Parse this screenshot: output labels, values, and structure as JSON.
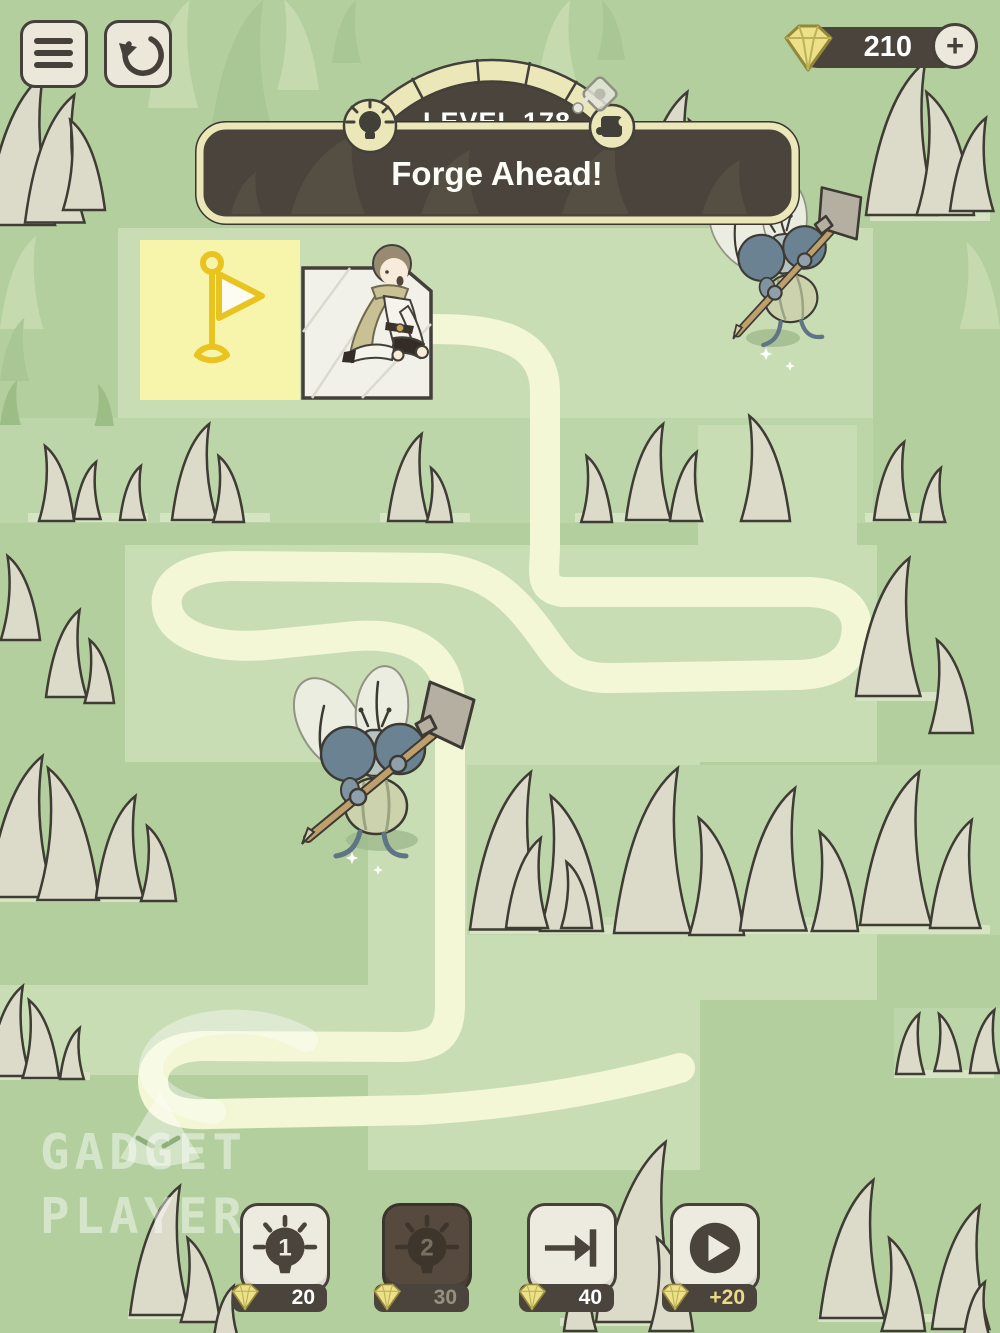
{
  "hud": {
    "menu_icon": "hamburger-icon",
    "restart_icon": "restart-icon",
    "gems": {
      "count": "210",
      "add_label": "+",
      "gem_icon": "gem-icon"
    }
  },
  "level": {
    "label": "LEVEL 178",
    "title": "Forge Ahead!",
    "hint_badge_icon": "lightbulb-icon",
    "puzzle_badge_icon": "puzzle-piece-icon"
  },
  "board": {
    "goal_icon": "flag-icon",
    "player": "kneeling-boy-character",
    "enemies": [
      "fly-with-swatter",
      "fly-with-swatter"
    ],
    "drawn_path": "hand-drawn-cream-line"
  },
  "toolbar": {
    "hint1": {
      "number": "1",
      "cost": "20"
    },
    "hint2": {
      "number": "2",
      "cost": "30"
    },
    "skip": {
      "cost": "40"
    },
    "reward": {
      "cost": "+20"
    }
  },
  "watermark": {
    "line1": "GADGET",
    "line2": "PLAYER"
  },
  "colors": {
    "base_green": "#b3cf9e",
    "light_green": "#c9ddb5",
    "path_cream": "#f3f7d6",
    "dark_brown": "#4a443c",
    "cream": "#edeadf",
    "gem_yellow": "#ece189",
    "flag_yellow": "#f7f4ab",
    "flag_gold": "#e9c31f"
  }
}
